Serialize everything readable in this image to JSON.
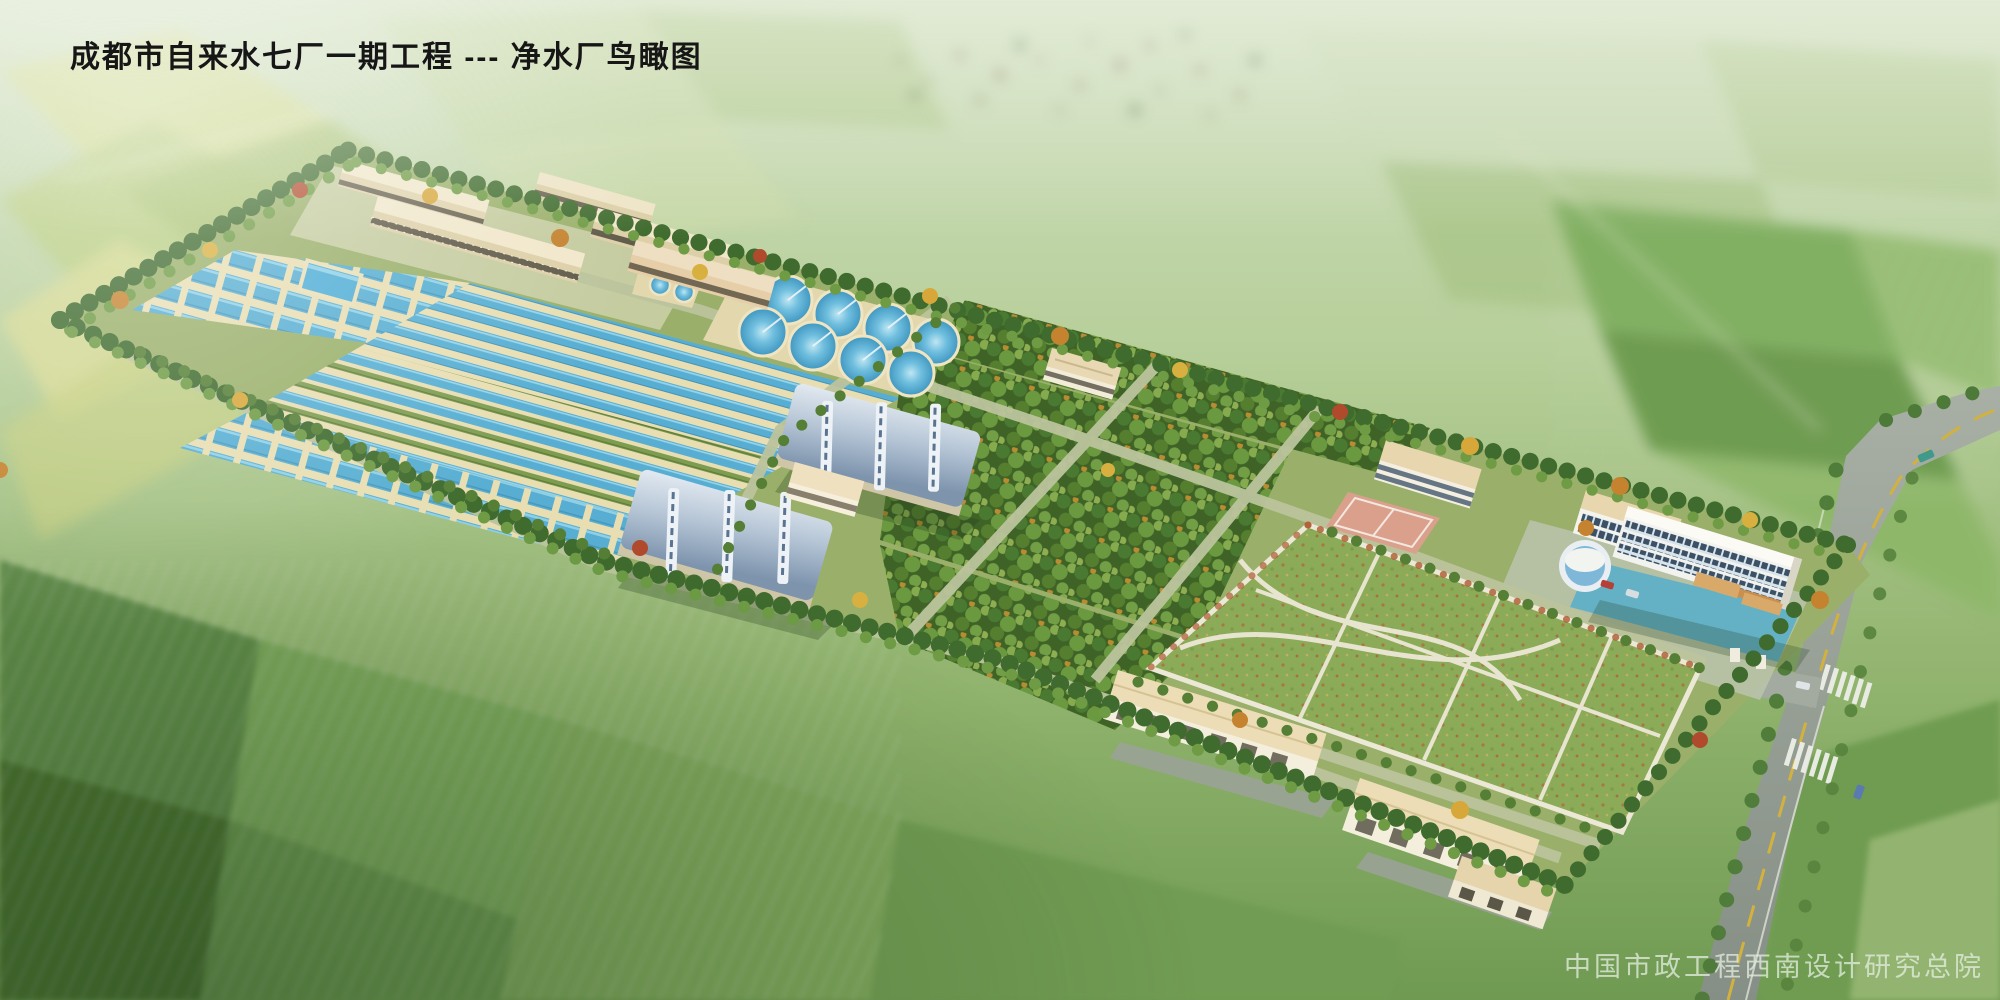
{
  "meta": {
    "image_kind": "architectural-aerial-rendering",
    "width": 2000,
    "height": 1000
  },
  "header": {
    "title": "成都市自来水七厂一期工程 --- 净水厂鸟瞰图"
  },
  "footer": {
    "credit": "中国市政工程西南设计研究总院"
  },
  "palette": {
    "farmland_light": "#cfe0b8",
    "farmland_green": "#7da65a",
    "site_ground": "#9ab06a",
    "basin_water": "#57aed2",
    "basin_wall": "#e8deb2",
    "arch_roof_blue": "#9fb3c8",
    "building_tan": "#ecdfbf",
    "building_white": "#f2f3ee",
    "tree_green": "#4a7a31",
    "tree_autumn_orange": "#c5832f",
    "lawn_green": "#8cab58",
    "path_white": "#ece8d6",
    "road_gray": "#99a29a",
    "road_line_yellow": "#d2b13e",
    "court_pink": "#dba08c"
  }
}
